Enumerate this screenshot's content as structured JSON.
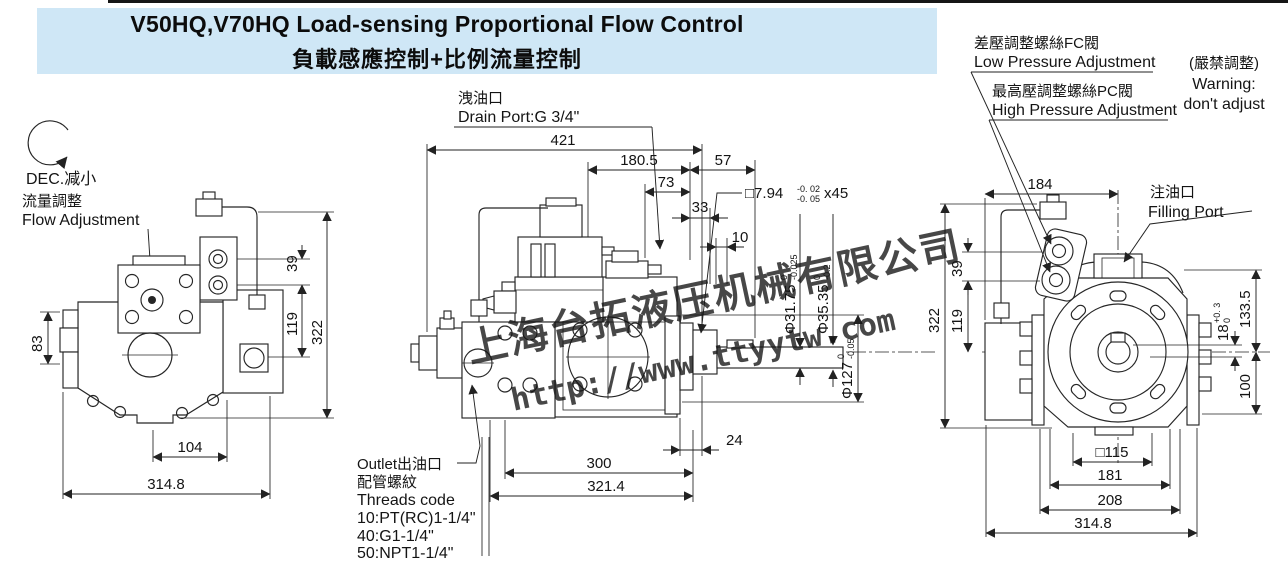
{
  "title": {
    "en": "V50HQ,V70HQ Load-sensing Proportional Flow Control",
    "zh": "負載感應控制+比例流量控制"
  },
  "colors": {
    "band": "#cfe7f6",
    "watermark_blue": "#2b50e8",
    "line": "#262626"
  },
  "watermark": {
    "company": "上海台拓液压机械有限公司",
    "url": "http://www.ttyytw.com"
  },
  "left_view": {
    "dec_label": "DEC.减小",
    "flow_zh": "流量調整",
    "flow_en": "Flow Adjustment",
    "dims": {
      "h83": "83",
      "w104": "104",
      "w3148": "314.8",
      "h39": "39",
      "h119": "119",
      "h322": "322"
    }
  },
  "center_view": {
    "drain_zh": "洩油口",
    "drain_en": "Drain Port:G 3/4\"",
    "outlet": [
      "Outlet出油口",
      "配管螺紋",
      "Threads code",
      "10:PT(RC)1-1/4\"",
      "40:G1-1/4\"",
      "50:NPT1-1/4\""
    ],
    "dims": {
      "w421": "421",
      "w1805": "180.5",
      "w57": "57",
      "w73": "73",
      "w33": "33",
      "w10": "10",
      "w24": "24",
      "w300": "300",
      "w3214": "321.4"
    },
    "callouts": {
      "key": {
        "main": "□7.94",
        "tol_top": "-0. 02",
        "tol_bot": "-0. 05",
        "suffix": "x45"
      },
      "shaft_small": {
        "main": "Φ31.75",
        "tol_top": "0",
        "tol_bot": "-0.025"
      },
      "shaft_large": {
        "main": "Φ35.35",
        "tol_top": "0",
        "tol_bot": "-0.2"
      },
      "pilot": {
        "main": "Φ127",
        "tol_top": "0",
        "tol_bot": "-0.05"
      }
    }
  },
  "right_view": {
    "fc_zh": "差壓調整螺絲FC閥",
    "fc_en": "Low Pressure Adjustment",
    "pc_zh": "最高壓調整螺絲PC閥",
    "pc_en": "High Pressure Adjustment",
    "warn_zh": "(嚴禁調整)",
    "warn_en1": "Warning:",
    "warn_en2": "don't adjust",
    "fill_zh": "注油口",
    "fill_en": "Filling Port",
    "dims": {
      "w184": "184",
      "h39": "39",
      "h119": "119",
      "h322": "322",
      "h1335": "133.5",
      "h100": "100",
      "w115": "□115",
      "w181": "181",
      "w208": "208",
      "w3148": "314.8"
    },
    "key18": {
      "main": "18",
      "tol_top": "+0. 3",
      "tol_bot": "0"
    }
  }
}
